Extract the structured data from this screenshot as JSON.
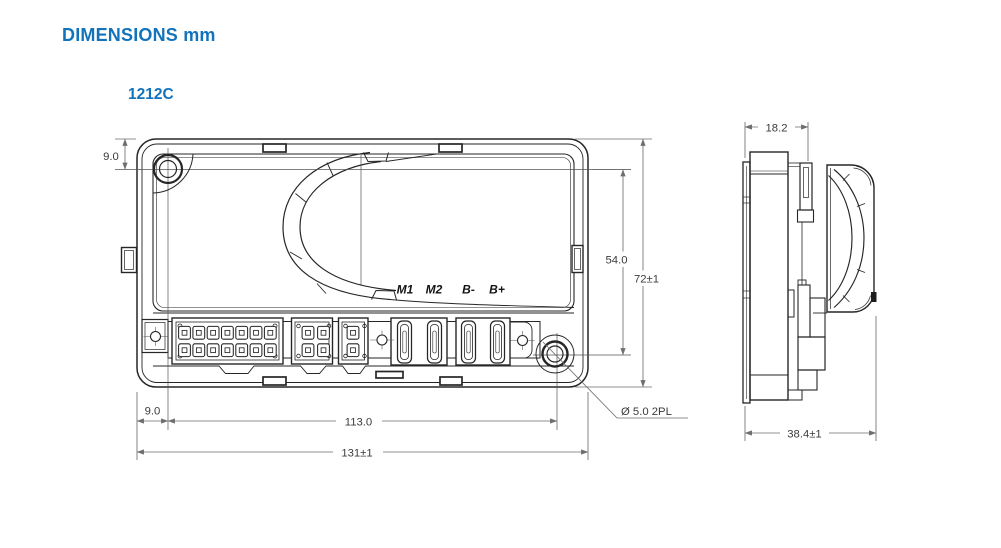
{
  "page": {
    "title": "DIMENSIONS mm",
    "model": "1212C"
  },
  "front_view": {
    "terminal_labels": [
      "M1",
      "M2",
      "B-",
      "B+"
    ],
    "dimensions": {
      "top_edge_to_hole_center": "9.0",
      "hole_spacing_vertical": "54.0",
      "overall_height": "72±1",
      "left_edge_to_hole_center": "9.0",
      "hole_spacing_horizontal": "113.0",
      "overall_width": "131±1",
      "mounting_hole_note": "Ø 5.0 2PL"
    }
  },
  "side_view": {
    "dimensions": {
      "base_depth": "18.2",
      "overall_depth": "38.4±1"
    }
  },
  "colors": {
    "accent_blue": "#1273BD",
    "line_dark": "#262626",
    "dim_gray": "#6e6e6e"
  }
}
